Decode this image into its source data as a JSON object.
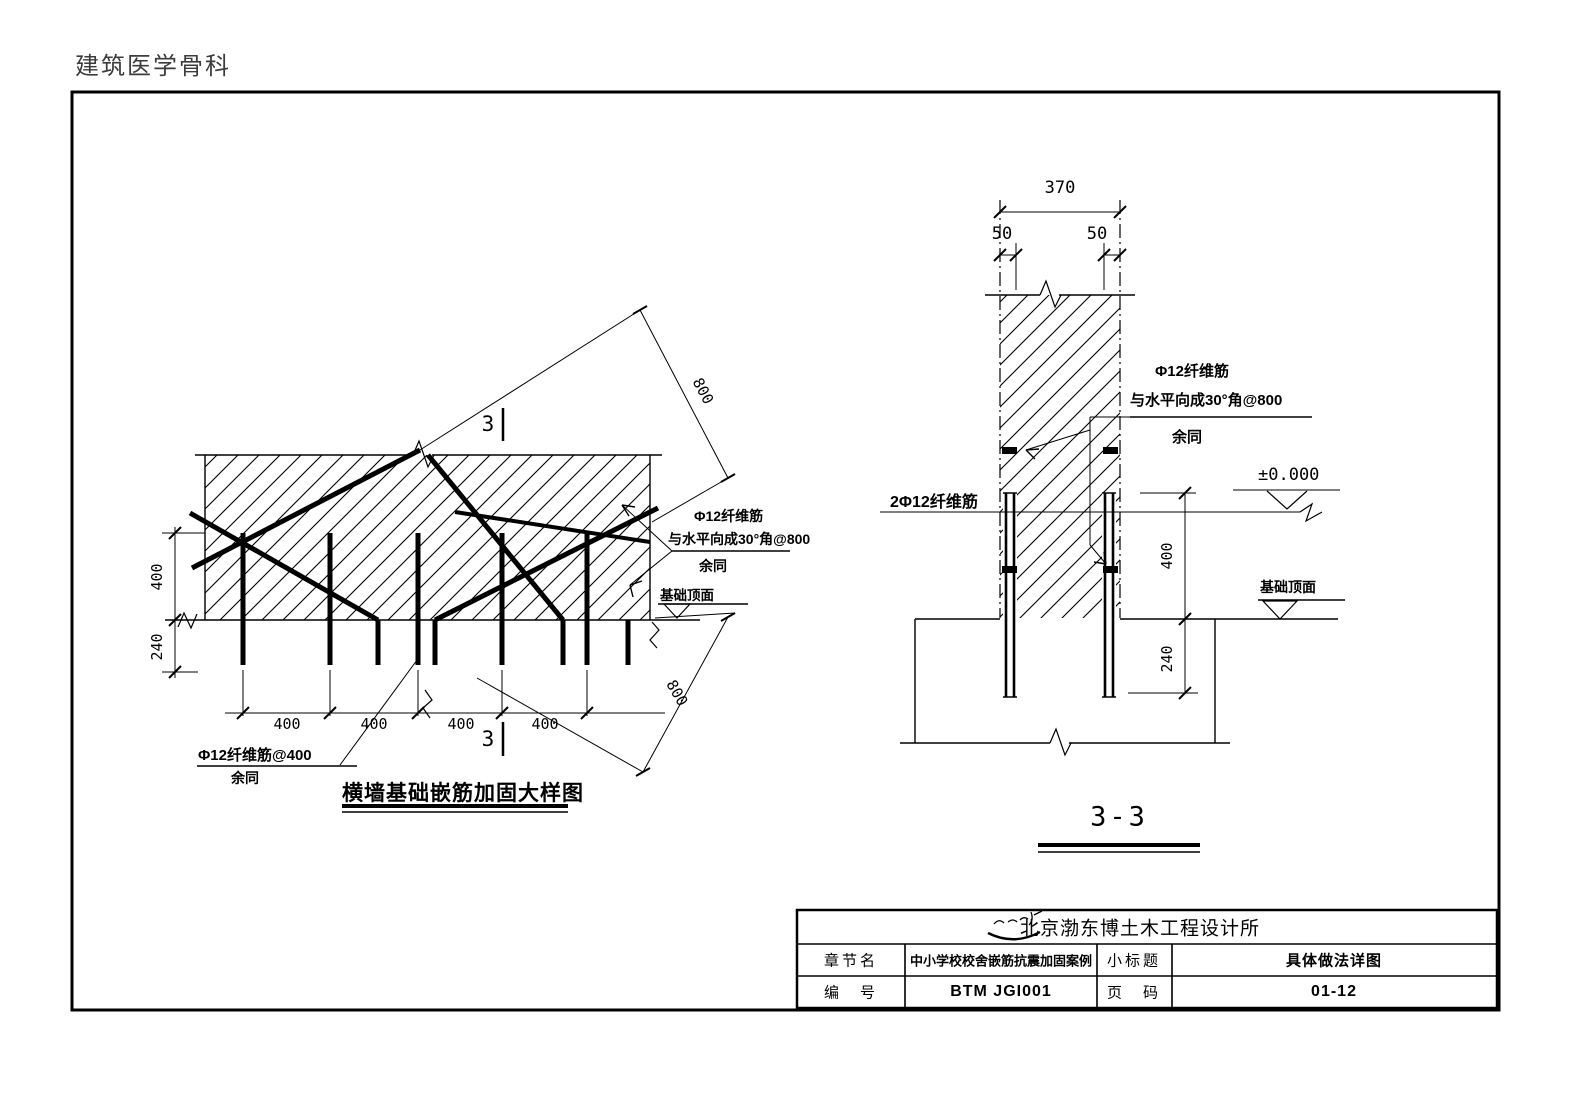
{
  "colors": {
    "line": "#000000",
    "background": "#ffffff"
  },
  "header": {
    "title": "建筑医学骨科"
  },
  "left": {
    "title": "横墙基础嵌筋加固大样图",
    "section_top": "3",
    "section_bottom": "3",
    "dim_left_upper": "400",
    "dim_left_lower": "240",
    "dim_bottom": [
      "400",
      "400",
      "400",
      "400"
    ],
    "dim_diag_top": "800",
    "dim_diag_bottom": "800",
    "note_fiber_1": "Φ12纤维筋",
    "note_fiber_2": "与水平向成30°角@800",
    "note_fiber_3": "余同",
    "note_foundation_top": "基础顶面",
    "note_dowel_1": "Φ12纤维筋@400",
    "note_dowel_2": "余同"
  },
  "right": {
    "title": "3-3",
    "dim_top": "370",
    "dim_50_left": "50",
    "dim_50_right": "50",
    "dim_right_upper": "400",
    "dim_right_lower": "240",
    "note_fiber_1": "Φ12纤维筋",
    "note_fiber_2": "与水平向成30°角@800",
    "note_fiber_3": "余同",
    "note_pair": "2Φ12纤维筋",
    "level_zero": "±0.000",
    "note_foundation_top": "基础顶面"
  },
  "title_block": {
    "company": "北京渤东博土木工程设计所",
    "logo": "company-logo",
    "row1_label1": "章节名",
    "row1_value1": "中小学校校舍嵌筋抗震加固案例",
    "row1_label2": "小标题",
    "row1_value2": "具体做法详图",
    "row2_label1": "编　号",
    "row2_value1": "BTM JGI001",
    "row2_label2": "页　码",
    "row2_value2": "01-12"
  }
}
